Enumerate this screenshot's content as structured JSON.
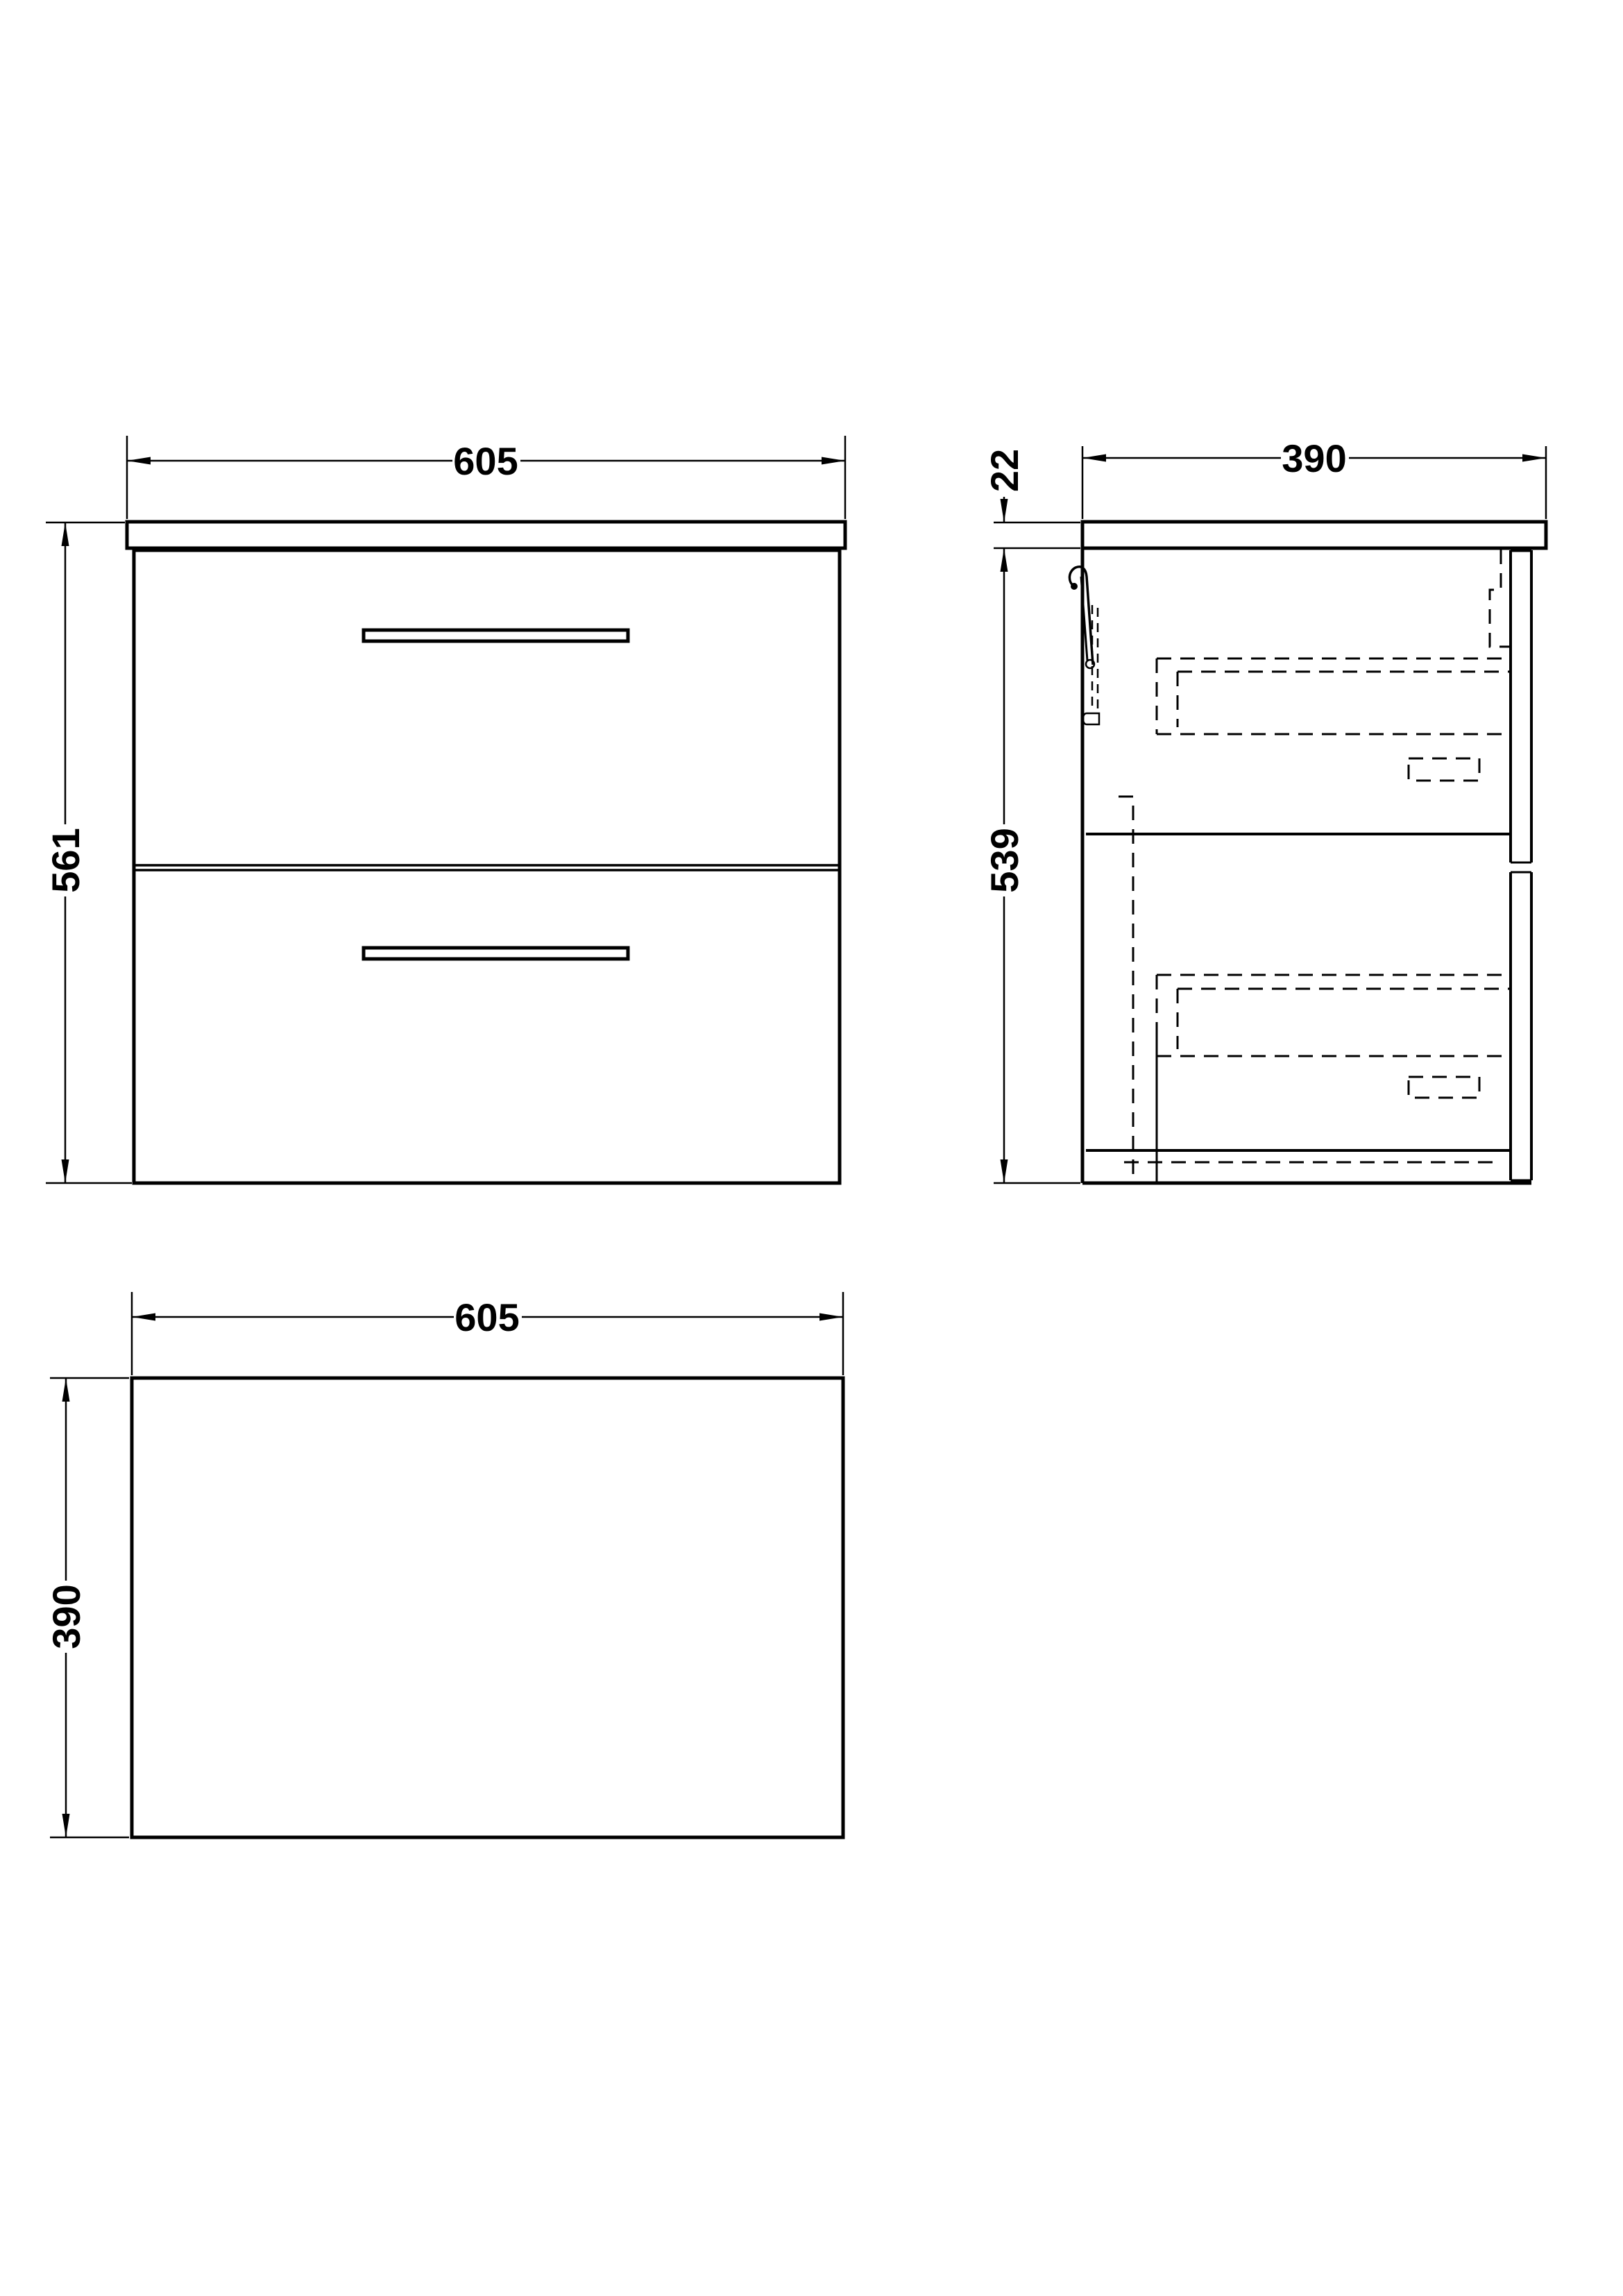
{
  "page": {
    "background_color": "#ffffff",
    "line_color": "#000000",
    "description": "Technical dimension drawing of a wall-hung two-drawer vanity unit with worktop: front elevation, side elevation and plan view"
  },
  "views": {
    "front_elevation": {
      "dims": {
        "width": "605",
        "height": "561"
      }
    },
    "side_elevation": {
      "dims": {
        "depth": "390",
        "worktop_thickness": "22",
        "cabinet_height": "539"
      }
    },
    "plan": {
      "dims": {
        "width": "605",
        "depth": "390"
      }
    }
  }
}
